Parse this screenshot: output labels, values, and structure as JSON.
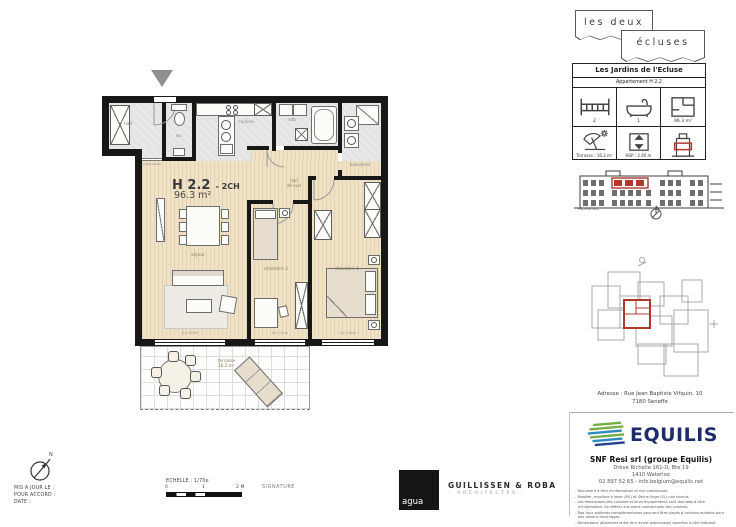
{
  "plan": {
    "title": "H 2.2",
    "title_suffix": "- 2CH",
    "area": "96.3 m²",
    "rooms": {
      "hall": "hall",
      "wc": "wc",
      "cuisine": "cuisine",
      "sdb": "sdb",
      "buanderie": "buanderie",
      "hall_de_nuit_line1": "hall",
      "hall_de_nuit_line2": "de nuit",
      "sejour": "séjour",
      "chambre2": "chambre 2",
      "chambre1": "chambre 1"
    },
    "terrasse": {
      "label": "terrasse",
      "area": "16.2 m²"
    },
    "porte_vitree": "porte vitrée",
    "window_notes": {
      "sejour": "A.h 60cm",
      "chambre2": "A.h 75cm",
      "chambre1": "A.h 90cm"
    }
  },
  "brand": {
    "line1": "les deux",
    "line2": "écluses"
  },
  "info_card": {
    "title": "Les Jardins de l'Ecluse",
    "subtitle": "Appartement H 2.2",
    "bedrooms": "2",
    "bathrooms": "1",
    "area": "96.3 m²",
    "terrace": "Terrasse : 16.2 m²",
    "height": "HSP : 2.60 m"
  },
  "elevation": {
    "label": "Façade Est"
  },
  "address": {
    "line1": "Adresse : Rue Jean Baptiste Vifquin, 10",
    "line2": "7180 Seneffe"
  },
  "developer": {
    "logo": "EQUILIS",
    "company": "SNF Resi srl (groupe Equilis)",
    "street": "Drève Richelle 161-D, Bte 19",
    "city": "1410 Waterloo",
    "contact": "02 897 52 65 - info.belgium@equilis.net",
    "notes": [
      "Document à titre d'information et non contractuel.",
      "Mobilier, machine à laver (ML) et Sèche-linge (SL) non fournis.",
      "Les dimensions des cuisines et leurs équipements sont données à titre d'information. Se référer aux plans contractuels des cuisines.",
      "Des faux-plafonds complémentaires pourront être placés à certains endroits pour des raisons techniques.",
      "Dimensions (distances entre mur avant plafonnage) données à titre indicatif."
    ]
  },
  "footer": {
    "updated": "MIS A JOUR LE :",
    "approval": "POUR ACCORD :",
    "date": "DATE :",
    "scale_label": "ECHELLE : 1/70e",
    "scale_0": "0",
    "scale_1": "1",
    "scale_2": "2 M",
    "signature": "SIGNATURE",
    "agua": "agua",
    "architects": "GUILLISSEN & ROBA",
    "architects_sub": "- ARCHITECTES -",
    "north": "N"
  },
  "colors": {
    "accent_red": "#b3382c",
    "wall": "#171717",
    "floor_beige": "#efe2c6",
    "equilis_navy": "#1d2d6b",
    "equilis_green": "#74b043",
    "equilis_blue": "#2f89bd"
  }
}
